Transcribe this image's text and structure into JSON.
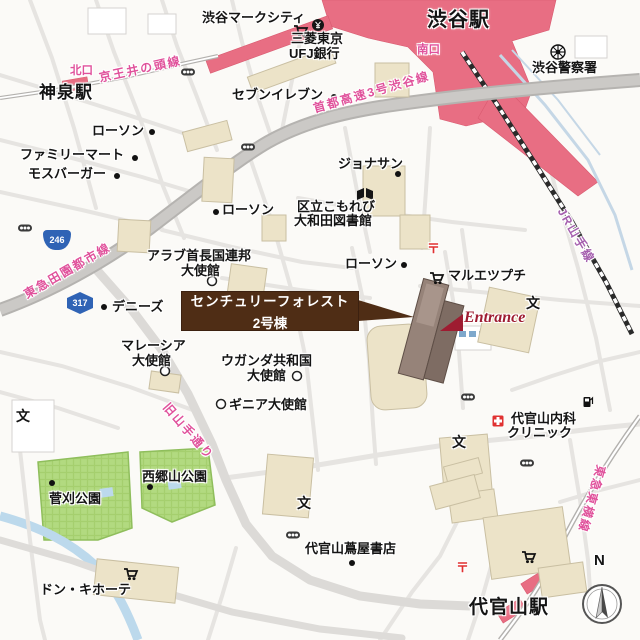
{
  "labels": {
    "shibuya_mark_city": "渋谷マークシティ",
    "shibuya_station": "渋谷駅",
    "mitsubishi_line1": "三菱東京",
    "mitsubishi_line2": "UFJ銀行",
    "south_exit": "南口",
    "north_exit": "北口",
    "shibuya_police": "渋谷警察署",
    "seven_eleven": "セブンイレブン",
    "keio_inokashira_line": "京王井の頭線",
    "shinsen_station": "神泉駅",
    "lawson": "ローソン",
    "family_mart": "ファミリーマート",
    "mos_burger": "モスバーガー",
    "shuto_expressway": "首都高速3号渋谷線",
    "jonathans": "ジョナサン",
    "library_line1": "区立こもれび",
    "library_line2": "大和田図書館",
    "route_246": "246",
    "route_317": "317",
    "denentoshi_line": "東急田園都市線",
    "uae_embassy_line1": "アラブ首長国連邦",
    "uae_embassy_line2": "大使館",
    "dennys": "デニーズ",
    "maruetsu_petit": "マルエツプチ",
    "yamanote_line": "JR山手線",
    "callout_line1": "センチュリーフォレスト",
    "callout_line2": "2号棟",
    "entrance": "Entrance",
    "malaysia_embassy_line1": "マレーシア",
    "malaysia_embassy_line2": "大使館",
    "uganda_embassy_line1": "ウガンダ共和国",
    "uganda_embassy_line2": "大使館",
    "guinea_embassy": "ギニア大使館",
    "kyu_yamate_street": "旧山手通り",
    "clinic_line1": "代官山内科",
    "clinic_line2": "クリニック",
    "saigoyama_park": "西郷山公園",
    "sugekari_park": "菅刈公園",
    "tsutaya_books": "代官山蔦屋書店",
    "don_quijote": "ドン・キホーテ",
    "toyoko_line": "東急東横線",
    "daikanyama_station": "代官山駅",
    "school_mark": "文",
    "post_mark": "〒",
    "compass_north": "N"
  },
  "colors": {
    "station_red": "#e86e83",
    "park_green": "#b2da80",
    "building_beige": "#ece3c8",
    "target_building_brown": "#8f7c74",
    "callout_brown": "#4f2d15",
    "rail_label_pink": "#e0519b",
    "yamanote_label_purple": "#a55fae",
    "entrance_red": "#9e1c31",
    "river_blue": "#bcd9ec",
    "route_shield_blue": "#2f63b5"
  }
}
